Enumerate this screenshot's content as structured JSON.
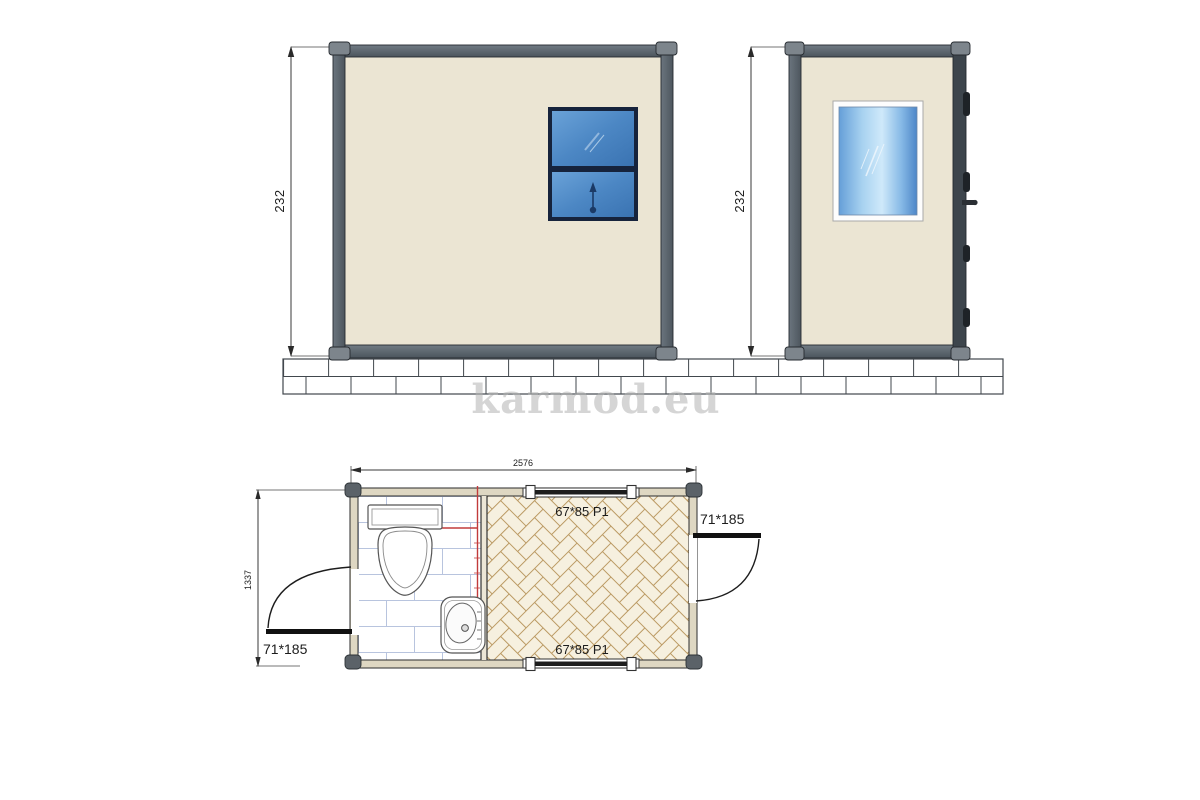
{
  "watermark": "karmod.eu",
  "front_elevation": {
    "height_label": "232"
  },
  "side_elevation": {
    "height_label": "232"
  },
  "plan": {
    "width_label": "2576",
    "depth_label": "1337",
    "top_window_label": "67*85 P1",
    "bottom_window_label": "67*85 P1",
    "left_door_label": "71*185",
    "right_door_label": "71*185"
  },
  "colors": {
    "frame_gray": "#5d6770",
    "corner_cap_gray": "#7d858c",
    "wall_cream": "#ebe5d3",
    "plan_wall_cream": "#ded7c2",
    "window_blue_dark": "#3a73b2",
    "window_blue_light": "#a8d2f0",
    "tile_line_blue": "#b8c4de",
    "herringbone_tan": "#bb9a63",
    "herringbone_floor": "#f6f0df",
    "red_marker": "#c23b3b",
    "brick_line": "#41474d"
  }
}
